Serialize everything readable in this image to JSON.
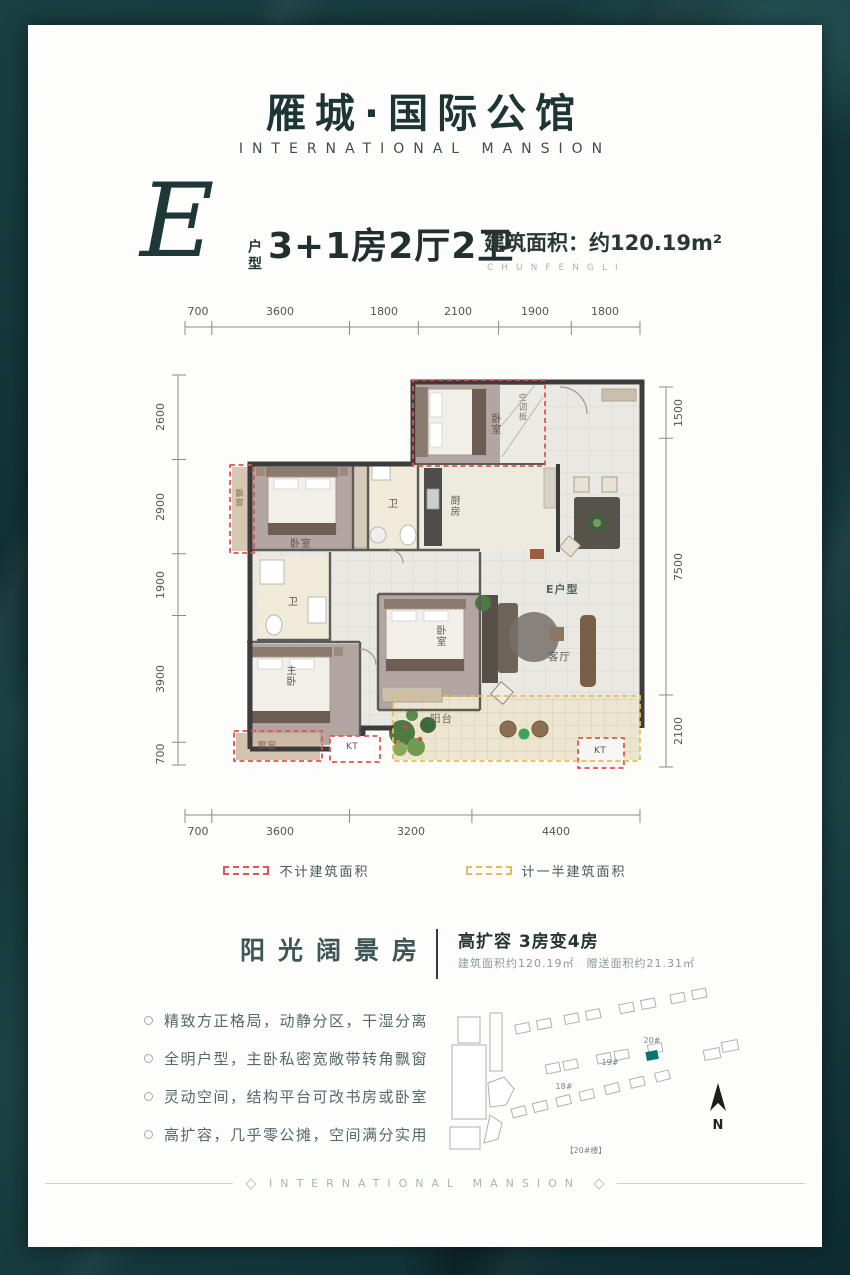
{
  "brand": {
    "title": "雁城·国际公馆",
    "subtitle": "INTERNATIONAL MANSION"
  },
  "unit": {
    "letter": "E",
    "type_label": "户型",
    "layout": "3+1房2厅2卫",
    "area": "建筑面积：约120.19m²",
    "series_en": "CHUNFENGLI"
  },
  "plan": {
    "dims_top": [
      "700",
      "3600",
      "1800",
      "2100",
      "1900",
      "1800"
    ],
    "dims_bottom": [
      "700",
      "3600",
      "3200",
      "4400"
    ],
    "dims_left": [
      "2600",
      "2900",
      "1900",
      "3900",
      "700"
    ],
    "dims_right": [
      "1500",
      "7500",
      "2100"
    ],
    "labels": {
      "bedroom_top": "卧室",
      "ac_board": "空调板",
      "bay_left": "飘窗",
      "bedroom_left": "卧室",
      "bath1": "卫",
      "kitchen": "厨房",
      "unit_tag": "E户型",
      "bath2": "卫",
      "master": "主卧",
      "bedroom_mid": "卧室",
      "living": "客厅",
      "balcony": "阳台",
      "bay_bottom": "飘窗",
      "kt1": "KT",
      "kt2": "KT"
    }
  },
  "legend": {
    "no_count": "不计建筑面积",
    "half_count": "计一半建筑面积"
  },
  "highlight": {
    "title": "阳光阔景房",
    "headline": "高扩容 3房变4房",
    "sub": "建筑面积约120.19㎡　赠送面积约21.31㎡"
  },
  "features": [
    "精致方正格局，动静分区，干湿分离",
    "全明户型，主卧私密宽敞带转角飘窗",
    "灵动空间，结构平台可改书房或卧室",
    "高扩容，几乎零公摊，空间满分实用"
  ],
  "siteplan": {
    "b18": "18#",
    "b19": "19#",
    "b20": "20#",
    "caption": "【20#楼】",
    "north": "N"
  },
  "footer": {
    "text": "INTERNATIONAL MANSION"
  },
  "colors": {
    "accent_red": "#e05555",
    "accent_yellow": "#e3bf58",
    "teal": "#0e7472"
  }
}
